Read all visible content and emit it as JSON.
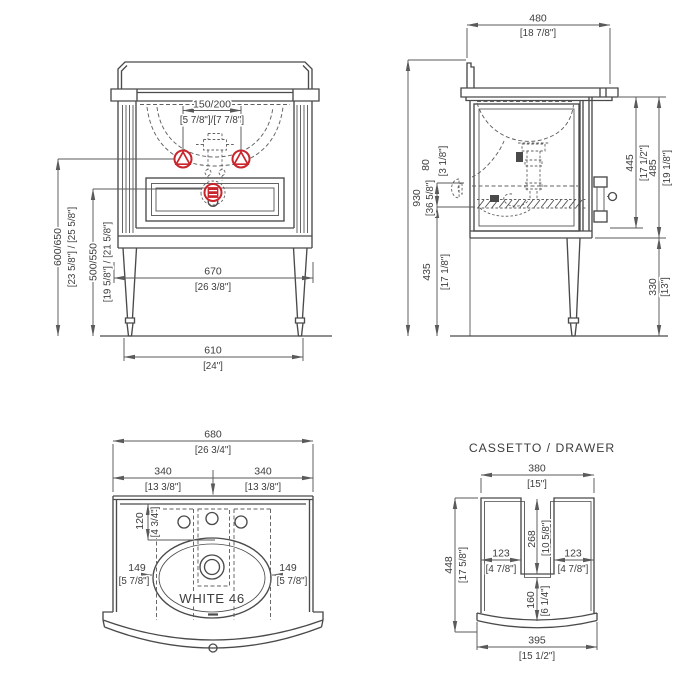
{
  "colors": {
    "background": "#ffffff",
    "line": "#4a4a4a",
    "dim_line": "#5a5a5a",
    "text": "#3d3d3d",
    "accent_red": "#c9252c"
  },
  "front_view": {
    "faucet_spacing": {
      "mm": "150/200",
      "inch": "[5 7/8\"]/[7 7/8\"]"
    },
    "supply_height": {
      "mm": "600/650",
      "inch": "[23 5/8\"] / [25 5/8\"]"
    },
    "drain_height": {
      "mm": "500/550",
      "inch": "[19 5/8\"] / [21 5/8\"]"
    },
    "top_width": {
      "mm": "670",
      "inch": "[26 3/8\"]"
    },
    "feet_span": {
      "mm": "610",
      "inch": "[24\"]"
    }
  },
  "side_view": {
    "depth": {
      "mm": "480",
      "inch": "[18 7/8\"]"
    },
    "total_height": {
      "mm": "930",
      "inch": "[36 5/8\"]"
    },
    "supply_offset": {
      "mm": "80",
      "inch": "[3 1/8\"]"
    },
    "drain_height": {
      "mm": "435",
      "inch": "[17 1/8\"]"
    },
    "front_height": {
      "mm": "445",
      "inch": "[17 1/2\"]"
    },
    "body_height": {
      "mm": "485",
      "inch": "[19 1/8\"]"
    },
    "leg_height": {
      "mm": "330",
      "inch": "[13\"]"
    }
  },
  "top_view": {
    "model_label": "WHITE 46",
    "overall_width": {
      "mm": "680",
      "inch": "[26 3/4\"]"
    },
    "half_width": {
      "mm": "340",
      "inch": "[13 3/8\"]"
    },
    "hole_setback": {
      "mm": "120",
      "inch": "[4 3/4\"]"
    },
    "side_to_basin": {
      "mm": "149",
      "inch": "[5 7/8\"]"
    }
  },
  "drawer_view": {
    "title": "CASSETTO / DRAWER",
    "top_width": {
      "mm": "380",
      "inch": "[15\"]"
    },
    "depth": {
      "mm": "448",
      "inch": "[17 5/8\"]"
    },
    "cutout_depth": {
      "mm": "268",
      "inch": "[10 5/8\"]"
    },
    "arm_width": {
      "mm": "123",
      "inch": "[4 7/8\"]"
    },
    "front_gap": {
      "mm": "160",
      "inch": "[6 1/4\"]"
    },
    "bottom_width": {
      "mm": "395",
      "inch": "[15 1/2\"]"
    }
  }
}
